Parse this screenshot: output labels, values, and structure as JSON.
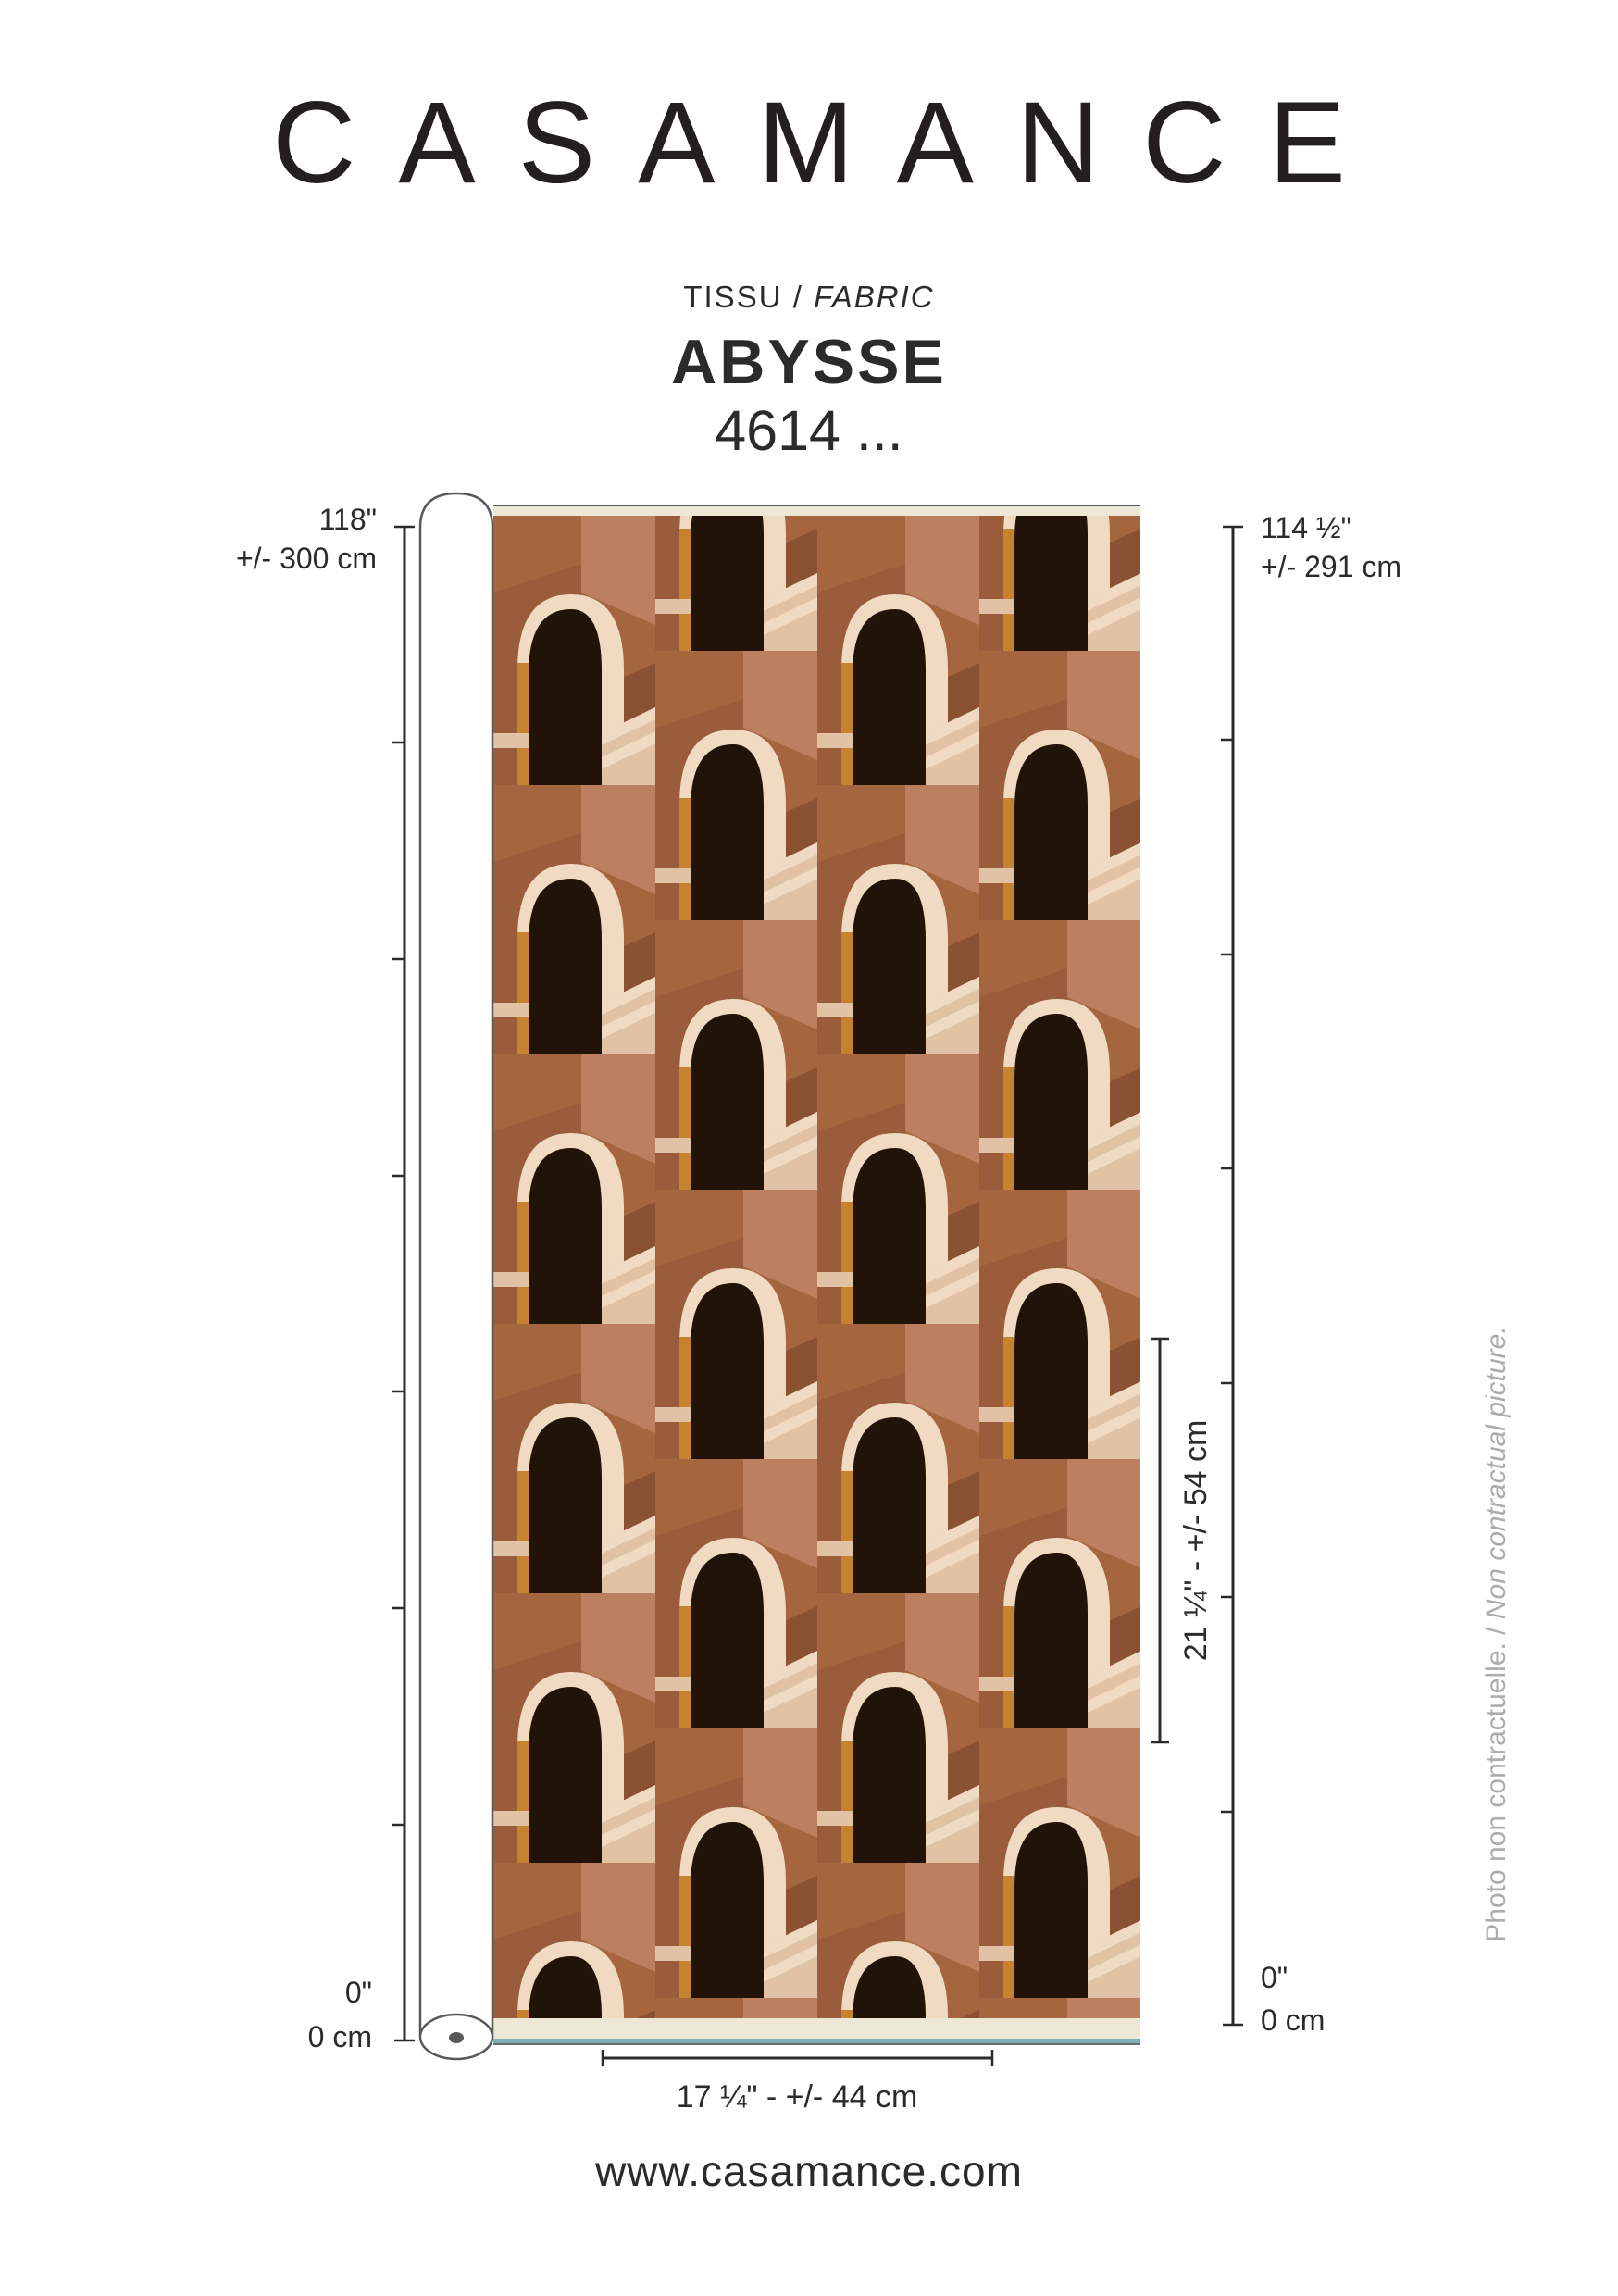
{
  "header": {
    "brand": "CASAMANCE",
    "category_fr": "TISSU",
    "category_divider": " / ",
    "category_en": "FABRIC",
    "product_name": "ABYSSE",
    "product_code": "4614 ..."
  },
  "measurements": {
    "left_top_inches": "118\"",
    "left_top_cm": "+/- 300 cm",
    "left_bottom_inches": "0\"",
    "left_bottom_cm": "0 cm",
    "right_top_inches": "114 ½\"",
    "right_top_cm": "+/- 291 cm",
    "right_bottom_inches": "0\"",
    "right_bottom_cm": "0 cm",
    "vertical_repeat": "21 ¼\" - +/- 54 cm",
    "horizontal_repeat": "17 ¼\" - +/- 44 cm"
  },
  "disclaimer": {
    "fr": "Photo non contractuelle.",
    "divider": " / ",
    "en": "Non contractual picture."
  },
  "footer": {
    "website": "www.casamance.com"
  },
  "fabric": {
    "palette": {
      "terracotta": "#A5663F",
      "terracotta_deep": "#9B5C3C",
      "salmon": "#BC7F5F",
      "shadow": "#8A5132",
      "cream": "#F0DAC1",
      "cream_shadow": "#E2C2A4",
      "black": "#221309",
      "orange": "#C5832F",
      "selvage": "#EDE7D5",
      "selvage_line": "#7FAEB6",
      "roll_outline": "#58595B",
      "roll_dot": "#58595B",
      "white": "#FFFFFF"
    }
  }
}
